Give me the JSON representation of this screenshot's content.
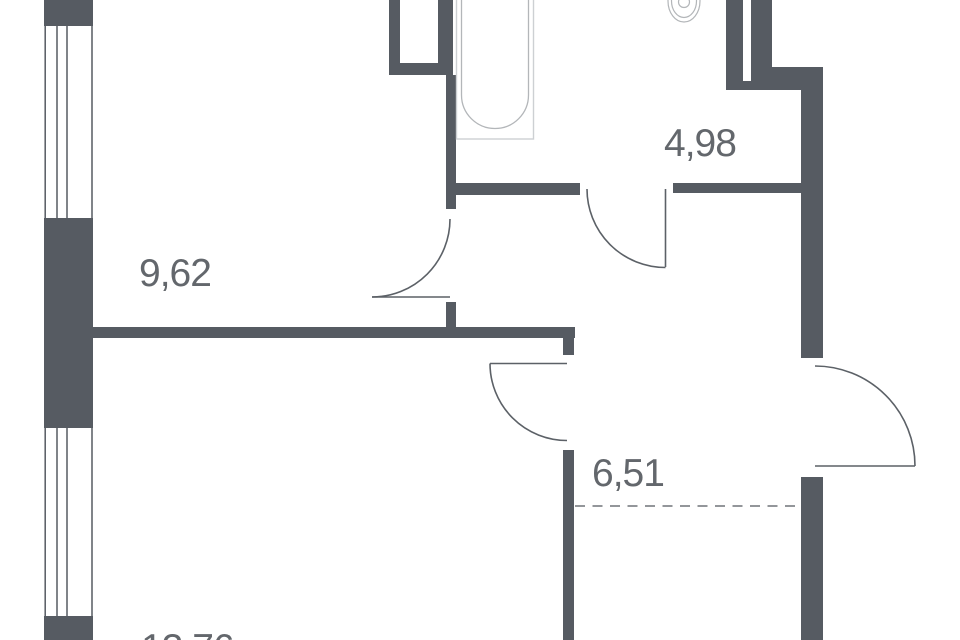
{
  "plan": {
    "rooms": [
      {
        "name": "room",
        "area_label": "9,62"
      },
      {
        "name": "bathroom",
        "area_label": "4,98"
      },
      {
        "name": "kitchen-niche",
        "area_label": "6,51"
      },
      {
        "name": "living-room",
        "area_label": "13,76"
      }
    ],
    "fixtures": [
      "bathtub",
      "sink",
      "ventilation-shaft",
      "window",
      "door-swing"
    ],
    "colors": {
      "wall": "#565b62",
      "line": "#5c6167",
      "fixture": "#b3b6b9",
      "fixture-light": "#cdd0d3",
      "dash": "#84888c",
      "text": "#63676c",
      "bg": "#ffffff"
    }
  }
}
